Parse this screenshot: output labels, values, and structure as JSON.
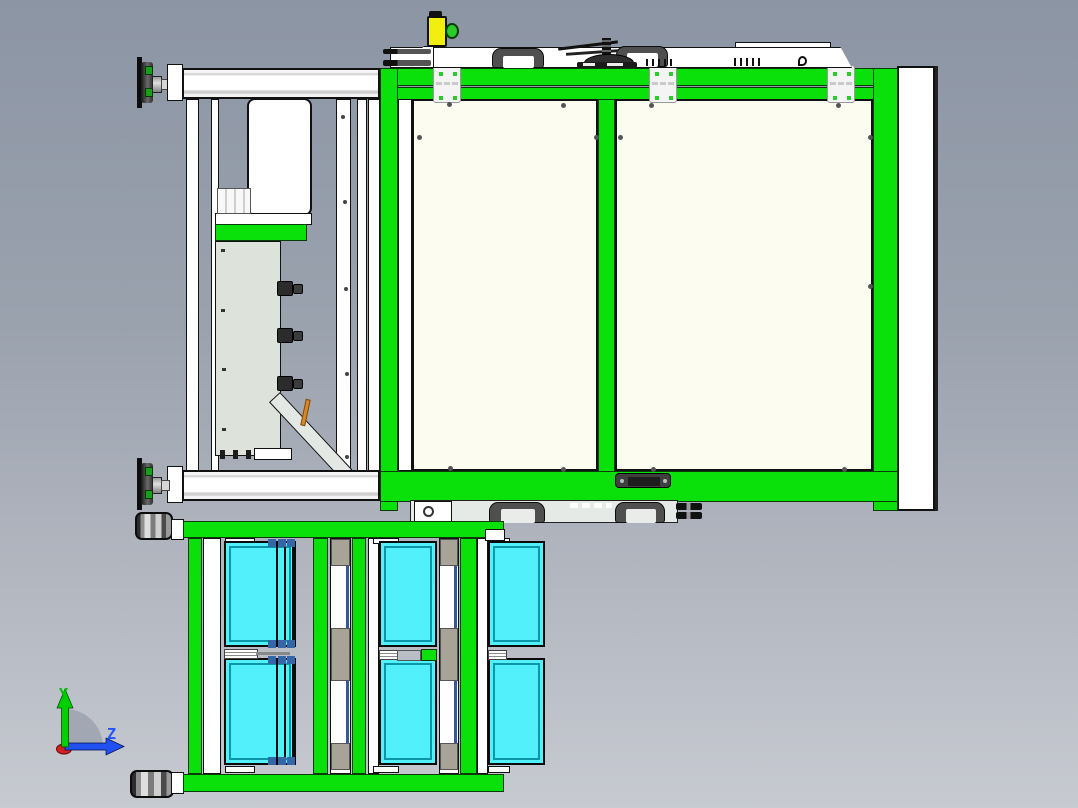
{
  "scene": {
    "type": "cad-3d-viewport",
    "view": "side view of machine assembly with tray cart",
    "visible_counts": {
      "cyan_trays": 6,
      "casters": 2,
      "carry_handles": 4,
      "adjustment_knobs": 3,
      "frame_connector_brackets": 3,
      "frame_panels": 2
    }
  },
  "axis_triad": {
    "y_label": "Y",
    "z_label": "Z"
  },
  "colors": {
    "bg-top": "#8c95a4",
    "bg-bottom": "#c7cad1",
    "frame-green": "#0ae00a",
    "tray-cyan": "#52f0fb",
    "tray-line": "#0a96a6",
    "panel-cream": "#fdfcf0",
    "panel-sage": "#dde3da",
    "accent-yellow": "#f2ee0f",
    "knob-green": "#2acc2a",
    "blue-square": "#3566a8",
    "taupe-block": "#a7a497",
    "conveyor-gray": "#e6eae7",
    "handle-dark": "#4f4f4f",
    "axis-y": "#00d000",
    "axis-z": "#2050f0",
    "axis-red": "#d42020"
  }
}
